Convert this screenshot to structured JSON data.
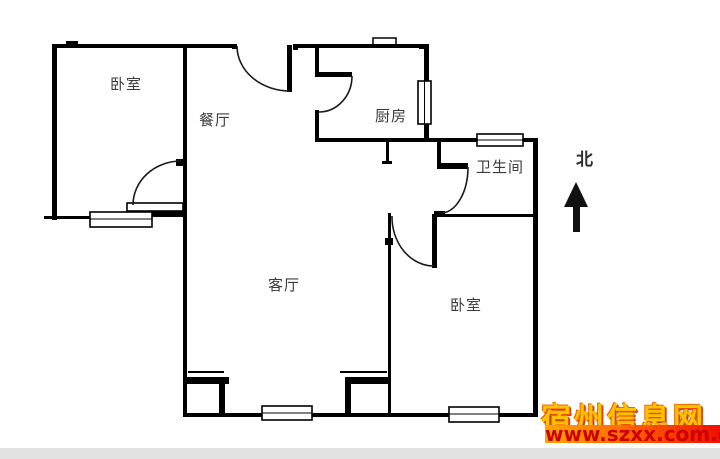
{
  "floor_plan": {
    "rooms": {
      "bedroom_top_left": "卧室",
      "dining_room": "餐厅",
      "kitchen": "厨房",
      "bathroom": "卫生间",
      "living_room": "客厅",
      "bedroom_bottom_right": "卧室"
    },
    "compass": {
      "label": "北",
      "icon": "north-arrow-icon"
    },
    "colors": {
      "wall": "#000000",
      "label": "#3c3c3c"
    }
  },
  "watermark": {
    "site_name": "宿州信息网",
    "url": "www.szxx.com.cn",
    "colors": {
      "site_name_fill": "#ffc100",
      "site_name_outline": "#d03000",
      "bar_gradient_start": "#ffa600",
      "bar_gradient_end": "#ef0f00",
      "url_text": "#cf0000"
    }
  }
}
